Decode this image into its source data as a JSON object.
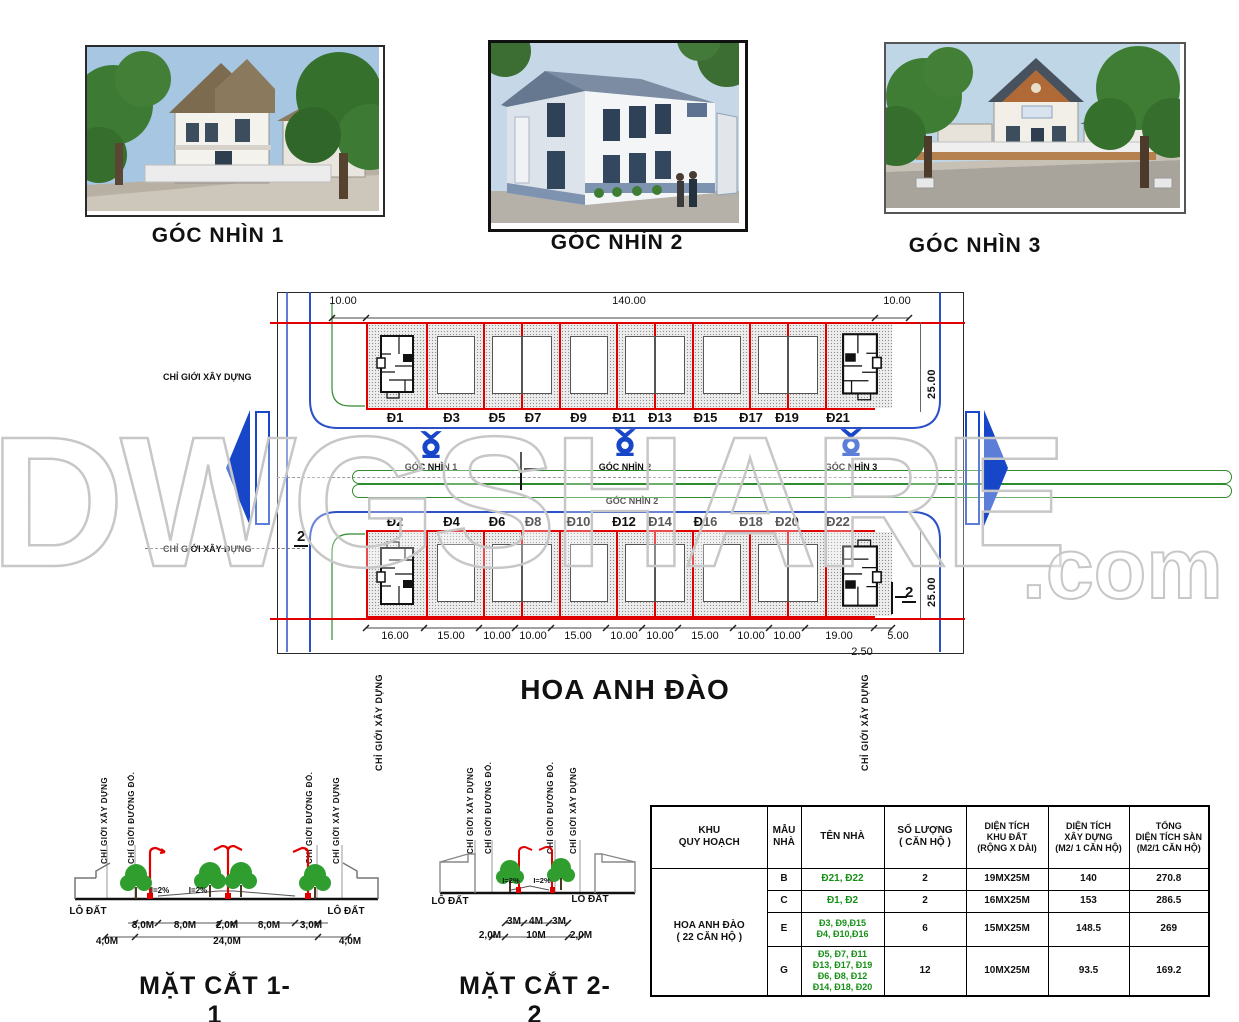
{
  "watermark": {
    "main": "DWGSHARE",
    "suffix": ".com"
  },
  "renders": [
    {
      "label": "GÓC NHÌN 1"
    },
    {
      "label": "GÓC NHÌN 2"
    },
    {
      "label": "GÓC NHÌN 3"
    }
  ],
  "site_plan": {
    "street_name": "HOA ANH ĐÀO",
    "boundary_label": "CHỈ GIỚI XÂY DỰNG",
    "top_dims": [
      "10.00",
      "140.00",
      "10.00"
    ],
    "side_dim": "25.00",
    "bottom_dims": [
      "16.00",
      "15.00",
      "10.00",
      "10.00",
      "15.00",
      "10.00",
      "10.00",
      "15.00",
      "10.00",
      "10.00",
      "19.00",
      "5.00"
    ],
    "offset_dim": "2.50",
    "top_lots": [
      "Đ1",
      "Đ3",
      "Đ5",
      "Đ7",
      "Đ9",
      "Đ11",
      "Đ13",
      "Đ15",
      "Đ17",
      "Đ19",
      "Đ21"
    ],
    "bottom_lots": [
      "Đ2",
      "Đ4",
      "Đ6",
      "Đ8",
      "Đ10",
      "Đ12",
      "Đ14",
      "Đ16",
      "Đ18",
      "Đ20",
      "Đ22"
    ],
    "camera_labels": [
      "GÓC NHÌN 1",
      "GÓC NHÌN 2",
      "GÓC NHÌN 3"
    ],
    "camera_label_bottom": "GÓC NHÌN 2",
    "cut_marker": "2"
  },
  "sections": [
    {
      "title": "MẶT CẮT 1-1",
      "dims_inner": [
        "3,0M",
        "8,0M",
        "2,0M",
        "8,0M",
        "3,0M"
      ],
      "dims_outer": [
        "4,0M",
        "24,0M",
        "4,0M"
      ],
      "slope": "I=2%",
      "lot_label": "LÔ ĐẤT",
      "build_line": "CHỈ GIỚI XÂY DỰNG",
      "red_line": "CHỈ GIỚI ĐƯỜNG ĐỎ."
    },
    {
      "title": "MẶT CẮT 2-2",
      "dims_inner": [
        "3M",
        "4M",
        "3M"
      ],
      "dims_outer": [
        "2,0M",
        "10M",
        "2,0M"
      ],
      "slope": "I=2%",
      "lot_label": "LÔ ĐẤT",
      "build_line": "CHỈ GIỚI XÂY DỰNG",
      "red_line": "CHỈ GIỚI ĐƯỜNG ĐỎ."
    }
  ],
  "table": {
    "headers": [
      "KHU\nQUY HOẠCH",
      "MẪU\nNHÀ",
      "TÊN NHÀ",
      "SỐ LƯỢNG\n( CĂN HỘ )",
      "DIỆN TÍCH\nKHU ĐẤT\n(RỘNG X DÀI)",
      "DIỆN TÍCH\nXÂY DỰNG\n(M2/ 1 CĂN HỘ)",
      "TỔNG\nDIỆN TÍCH SÀN\n(M2/1 CĂN HỘ)"
    ],
    "area_label": "HOA ANH ĐÀO\n( 22 CĂN HỘ )",
    "rows": [
      {
        "model": "B",
        "names": "Đ21, Đ22",
        "qty": "2",
        "plot": "19MX25M",
        "build_area": "140",
        "floor_area": "270.8"
      },
      {
        "model": "C",
        "names": "Đ1, Đ2",
        "qty": "2",
        "plot": "16MX25M",
        "build_area": "153",
        "floor_area": "286.5"
      },
      {
        "model": "E",
        "names": "Đ3, Đ9,Đ15\nĐ4, Đ10,Đ16",
        "qty": "6",
        "plot": "15MX25M",
        "build_area": "148.5",
        "floor_area": "269"
      },
      {
        "model": "G",
        "names": "Đ5, Đ7, Đ11\nĐ13, Đ17, Đ19\nĐ6, Đ8, Đ12\nĐ14, Đ18, Đ20",
        "qty": "12",
        "plot": "10MX25M",
        "build_area": "93.5",
        "floor_area": "169.2"
      }
    ]
  },
  "colors": {
    "lot_boundary": "#e00000",
    "road_curb": "#2b50c8",
    "median": "#2e8b2e",
    "camera_blue": "#1747c8",
    "table_green": "#169016"
  }
}
